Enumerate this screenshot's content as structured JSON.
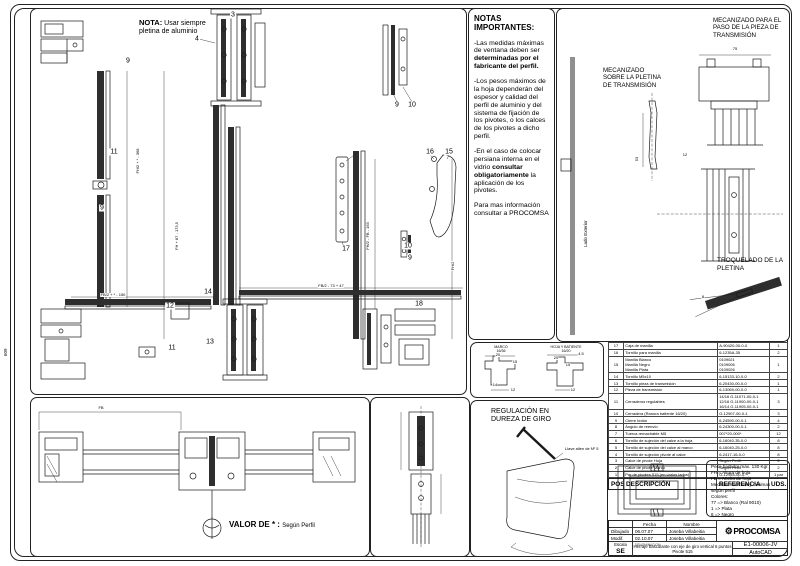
{
  "sheet": {
    "edge_label": "609"
  },
  "main_panel": {
    "note_title": "NOTA:",
    "note_body": " Usar siempre pletina de aluminio",
    "callouts": [
      {
        "label": "9",
        "x": 97,
        "y": 52
      },
      {
        "label": "11",
        "x": 83,
        "y": 143
      },
      {
        "label": "9",
        "x": 71,
        "y": 199
      },
      {
        "label": "3",
        "x": 202,
        "y": 6
      },
      {
        "label": "4",
        "x": 166,
        "y": 30
      },
      {
        "label": "9",
        "x": 366,
        "y": 96
      },
      {
        "label": "10",
        "x": 381,
        "y": 96
      },
      {
        "label": "16",
        "x": 399,
        "y": 143
      },
      {
        "label": "15",
        "x": 418,
        "y": 143
      },
      {
        "label": "17",
        "x": 315,
        "y": 240
      },
      {
        "label": "10",
        "x": 377,
        "y": 237
      },
      {
        "label": "9",
        "x": 379,
        "y": 249
      },
      {
        "label": "14",
        "x": 177,
        "y": 283
      },
      {
        "label": "12",
        "x": 139,
        "y": 297
      },
      {
        "label": "13",
        "x": 179,
        "y": 333
      },
      {
        "label": "11",
        "x": 141,
        "y": 339
      },
      {
        "label": "18",
        "x": 388,
        "y": 295
      }
    ],
    "dims": [
      {
        "label": "FH/2 + * - 368",
        "x": 107,
        "y": 152,
        "rot": true
      },
      {
        "label": "FH + 87 - 173,5",
        "x": 146,
        "y": 227,
        "rot": true
      },
      {
        "label": "FH/2 - FB - 163",
        "x": 337,
        "y": 227,
        "rot": true
      },
      {
        "label": "FH/2",
        "x": 422,
        "y": 257,
        "rot": true
      },
      {
        "label": "FB/2 + * - 150",
        "x": 82,
        "y": 286
      },
      {
        "label": "FB/2 - 73 + 47",
        "x": 300,
        "y": 277
      }
    ]
  },
  "notes_panel": {
    "title": "NOTAS IMPORTANTES:",
    "p1": "-Las medidas máximas de ventana deben ser **determinadas por el fabricante del perfil.**",
    "p2": "-Los pesos máximos de la hoja dependerán del espesor y calidad del perfil de aluminio y del sistema de fijación de los pivotes, o los calces de los pivotes a dicho perfil.",
    "p3": "-En el caso de colocar persiana interna en el vidrio **consultar obligatoriamente** la aplicación de los pivotes.",
    "p4": "Para mas información consultar a PROCOMSA"
  },
  "right_panel": {
    "paso_title": "MECANIZADO PARA EL PASO DE LA PIEZA DE TRANSMISIÓN",
    "pletina_title": "MECANIZADO SOBRE LA PLETINA DE TRANSMISIÓN",
    "troquelado_title": "TROQUELADO DE LA PLETINA",
    "lado_exterior": "Lado Exterior",
    "dims": [
      {
        "label": "75",
        "x": 178,
        "y": 40
      },
      {
        "label": "53",
        "x": 80,
        "y": 150,
        "rot": true
      },
      {
        "label": "12",
        "x": 128,
        "y": 146
      },
      {
        "label": "8",
        "x": 146,
        "y": 288
      }
    ]
  },
  "sections_panel": {
    "marco_label": "MARCO\n16/36",
    "hoja_label": "HOJA Y BATIENTE\n16/20",
    "dims": [
      {
        "label": "20",
        "x": 27,
        "y": 12
      },
      {
        "label": "15",
        "x": 44,
        "y": 19
      },
      {
        "label": "14",
        "x": 24,
        "y": 42
      },
      {
        "label": "12",
        "x": 42,
        "y": 47
      },
      {
        "label": "4.5",
        "x": 110,
        "y": 11
      },
      {
        "label": "20",
        "x": 85,
        "y": 15
      },
      {
        "label": "15",
        "x": 97,
        "y": 22
      },
      {
        "label": "12",
        "x": 102,
        "y": 47
      }
    ]
  },
  "bottom_left_panel": {
    "fb_label": "FB",
    "valor_label": "VALOR DE * : ",
    "valor_value": "Según Perfil"
  },
  "regulacion_panel": {
    "title": "REGULACIÓN EN\nDUREZA DE GIRO",
    "allen_label": "Llave allen de Nº 5"
  },
  "parts_table": {
    "headers": {
      "pos": "POS.",
      "desc": "DESCRIPCIÓN",
      "ref": "REFERENCIA",
      "uds": "UDS."
    },
    "rows": [
      {
        "pos": "17",
        "desc": "Caja de manilla",
        "ref": "A-90420-00-0-0",
        "uds": "1"
      },
      {
        "pos": "16",
        "desc": "Tornillo para manilla",
        "ref": "6-1235A-35",
        "uds": "2"
      },
      {
        "pos": "15",
        "desc": "Manilla Blanco\nManilla Negro\nManilla Plata",
        "ref": "0109021\n0109006\n0109026",
        "uds": "1"
      },
      {
        "pos": "14",
        "desc": "Tornillo M5x10",
        "ref": "6-15133-10-0-0",
        "uds": "2"
      },
      {
        "pos": "13",
        "desc": "Tornillo pieza de transmisión",
        "ref": "6-20430-00-0-0",
        "uds": "1"
      },
      {
        "pos": "12",
        "desc": "Pieza de transmisión",
        "ref": "6-13069-00-0-0",
        "uds": "1"
      },
      {
        "pos": "11",
        "desc": "Cerraderos regulables",
        "ref": "14/16  G-11071-00-0-1\n12/16  G-11900-00-0-1\n16/14  G-11905-00-0-1",
        "uds": "3"
      },
      {
        "pos": "10",
        "desc": "Cerradera (Ranura batiente 16/20)",
        "ref": "G-12907-00-0-1",
        "uds": "3"
      },
      {
        "pos": "9",
        "desc": "Cierre botón",
        "ref": "6-24590-00-0-1",
        "uds": "4"
      },
      {
        "pos": "8",
        "desc": "Ángulo de reenvío",
        "ref": "6-24300-00-0-1",
        "uds": "2"
      },
      {
        "pos": "7",
        "desc": "Tuerca remachable M5",
        "ref": "007*20-000*",
        "uds": "12"
      },
      {
        "pos": "6",
        "desc": "Tornillo de sujeción del calce a la hoja",
        "ref": "6-16040-35-0-0",
        "uds": "8"
      },
      {
        "pos": "5",
        "desc": "Tornillo de sujeción del calce al marco",
        "ref": "6-16040-25-0-0",
        "uds": "8"
      },
      {
        "pos": "4",
        "desc": "Tornillo de sujeción pivote al calce",
        "ref": "6-2417-16-0-0",
        "uds": "8"
      },
      {
        "pos": "3",
        "desc": "Calce de pivote Hoja",
        "ref": "Según Perfil",
        "uds": "2"
      },
      {
        "pos": "2",
        "desc": "Calce de pivote Marco",
        "ref": "Según Perfil",
        "uds": "2"
      },
      {
        "pos": "1",
        "desc": "Par de pivotes 515 (en varios lados)",
        "ref": "G-12954-00-0-*",
        "uds": "1 par"
      }
    ]
  },
  "info_box": {
    "lines": "Peso bastidor máx. 130 Kgr.\nFH = Altura de hoja\nFB = Ancho de hoja\nMedidas máximas y mínimas\nsegún perfil\nColores:\n77 => Blanco (Ral 9010)\n1 => Plata\n6 => Negro"
  },
  "title_block": {
    "fecha": "Fecha",
    "nombre": "Nombre",
    "dibujado": "Dibujado",
    "dibujado_fecha": "06.07.07",
    "dibujado_nombre": "Joseba Villabeitia",
    "modif": "Modif.",
    "modif_fecha": "02.10.07",
    "modif_nombre": "Joseba Villabeitia",
    "escala": "Escala",
    "escala_value": "SE",
    "denominacion": "DENOMINACION",
    "title_line1": "Herraje basculante con eje de giro vertical 6 puntos",
    "title_line2": "Pivote 515",
    "brand": "PROCOMSA",
    "gear_icon": "⚙",
    "doc_ref": "E1-00006-JV",
    "software": "AutoCAD"
  }
}
